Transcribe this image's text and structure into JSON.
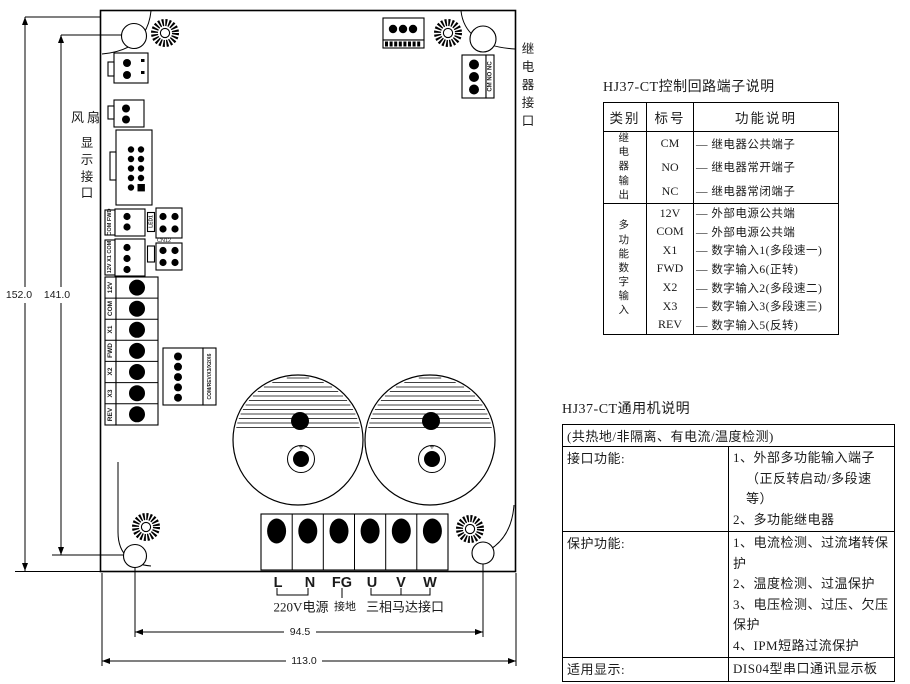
{
  "diagram": {
    "fan_label": "风扇",
    "display_port_label": "显示接口",
    "relay_port_label": "继电器接口",
    "dims": {
      "outer_height": "152.0",
      "inner_height": "141.0",
      "hole_span": "94.5",
      "outer_width": "113.0"
    },
    "power_terminals": [
      "L",
      "N",
      "FG",
      "U",
      "V",
      "W"
    ],
    "power_label": "220V电源",
    "ground_label": "接地",
    "motor_label": "三相马达接口",
    "input_terminals": [
      "12V",
      "COM",
      "X1",
      "FWD",
      "X2",
      "X3",
      "REV"
    ],
    "relay_conn_label": "CM NO NC",
    "conn_labels": {
      "com_fwd": "COM FWD",
      "v12_x1_com": "12V X1 COM",
      "cn5": "COM/REV/X3/X2/X6",
      "led1": "LED1",
      "cn12": "CN12"
    },
    "cap_plus": "+"
  },
  "terminal_table": {
    "title": "HJ37-CT控制回路端子说明",
    "headers": [
      "类别",
      "标号",
      "功能说明"
    ],
    "groups": [
      {
        "category": "继电器输出",
        "rows": [
          {
            "pin": "CM",
            "desc": "— 继电器公共端子"
          },
          {
            "pin": "NO",
            "desc": "— 继电器常开端子"
          },
          {
            "pin": "NC",
            "desc": "— 继电器常闭端子"
          }
        ]
      },
      {
        "category": "多功能数字输入",
        "rows": [
          {
            "pin": "12V",
            "desc": "— 外部电源公共端"
          },
          {
            "pin": "COM",
            "desc": "— 外部电源公共端"
          },
          {
            "pin": "X1",
            "desc": "— 数字输入1(多段速一)"
          },
          {
            "pin": "FWD",
            "desc": "— 数字输入6(正转)"
          },
          {
            "pin": "X2",
            "desc": "— 数字输入2(多段速二)"
          },
          {
            "pin": "X3",
            "desc": "— 数字输入3(多段速三)"
          },
          {
            "pin": "REV",
            "desc": "— 数字输入5(反转)"
          }
        ]
      }
    ]
  },
  "spec_table": {
    "title": "HJ37-CT通用机说明",
    "note": "(共热地/非隔离、有电流/温度检测)",
    "rows": [
      {
        "label": "接口功能:",
        "lines": [
          "1、外部多功能输入端子",
          "（正反转启动/多段速等）",
          "2、多功能继电器"
        ]
      },
      {
        "label": "保护功能:",
        "lines": [
          "1、电流检测、过流堵转保护",
          "2、温度检测、过温保护",
          "3、电压检测、过压、欠压保护",
          "4、IPM短路过流保护"
        ]
      },
      {
        "label": "适用显示:",
        "lines": [
          "DIS04型串口通讯显示板"
        ]
      }
    ]
  }
}
